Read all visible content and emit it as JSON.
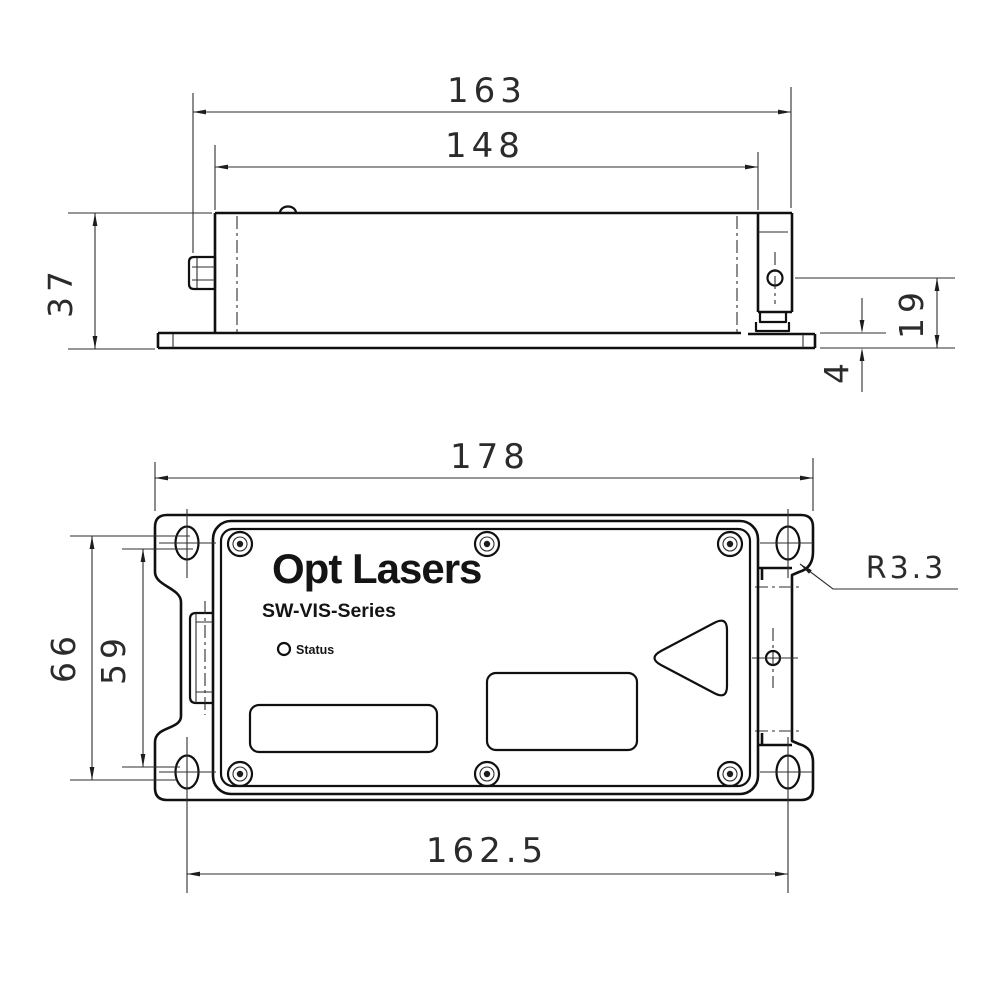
{
  "branding": {
    "logo": "Opt Lasers",
    "series": "SW-VIS-Series",
    "status_label": "Status"
  },
  "side_view": {
    "overall_length": "163",
    "body_length": "148",
    "height": "37",
    "aperture_height": "19",
    "base_thickness": "4"
  },
  "top_view": {
    "overall_width": "178",
    "slot_span_outer": "66",
    "slot_span_inner": "59",
    "slot_spacing": "162.5",
    "corner_radius": "R3.3"
  }
}
